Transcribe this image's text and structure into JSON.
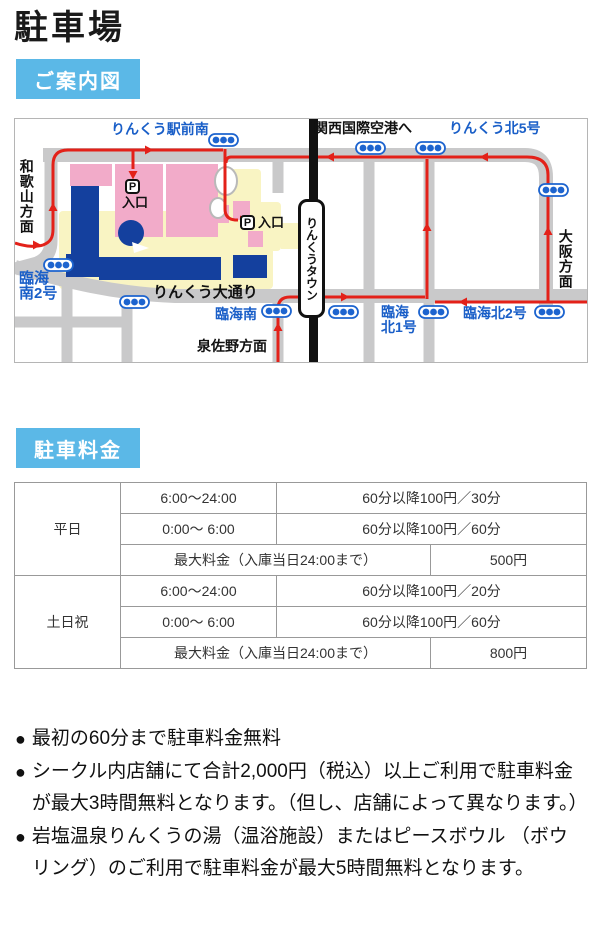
{
  "page": {
    "title": "駐車場"
  },
  "badges": {
    "guide_map": "ご案内図",
    "fees": "駐車料金"
  },
  "colors": {
    "badge_blue": "#5bb8e7",
    "map_road_gray": "#c9c9ca",
    "map_site_yellow": "#f9f4c3",
    "map_block_pink": "#f2abc9",
    "map_building_blue": "#14409e",
    "map_route_red": "#e32119",
    "map_label_blue": "#1a5fc8"
  },
  "map": {
    "labels": {
      "rinku_ekimae_minami": "りんくう駅前南",
      "to_kansai_airport": "関西国際空港へ",
      "rinku_kita_5": "りんくう北5号",
      "wakayama": "和歌山方面",
      "rinkai_minami_2_l1": "臨海",
      "rinkai_minami_2_l2": "南2号",
      "rinku_odori": "りんくう大通り",
      "rinkai_minami": "臨海南",
      "izumisano": "泉佐野方面",
      "station": "りんくうタウン",
      "rinkai_kita_1_l1": "臨海",
      "rinkai_kita_1_l2": "北1号",
      "rinkai_kita_2": "臨海北2号",
      "osaka": "大阪方面",
      "p": "P",
      "entrance": "入口"
    }
  },
  "fee_table": {
    "weekday": {
      "label": "平日",
      "slots": [
        {
          "time": "6:00〜24:00",
          "fee": "60分以降100円／30分"
        },
        {
          "time": "0:00〜 6:00",
          "fee": "60分以降100円／60分"
        }
      ],
      "max": {
        "label": "最大料金（入庫当日24:00まで）",
        "value": "500円"
      }
    },
    "weekend": {
      "label": "土日祝",
      "slots": [
        {
          "time": "6:00〜24:00",
          "fee": "60分以降100円／20分"
        },
        {
          "time": "0:00〜 6:00",
          "fee": "60分以降100円／60分"
        }
      ],
      "max": {
        "label": "最大料金（入庫当日24:00まで）",
        "value": "800円"
      }
    }
  },
  "notes": {
    "bullet": "●",
    "items": [
      "最初の60分まで駐車料金無料",
      "シークル内店舗にて合計2,000円（税込）以上ご利用で駐車料金が最大3時間無料となります。（但し、店舗によって異なります。）",
      "岩塩温泉りんくうの湯（温浴施設）またはピースボウル （ボウリング）のご利用で駐車料金が最大5時間無料となります。"
    ]
  }
}
